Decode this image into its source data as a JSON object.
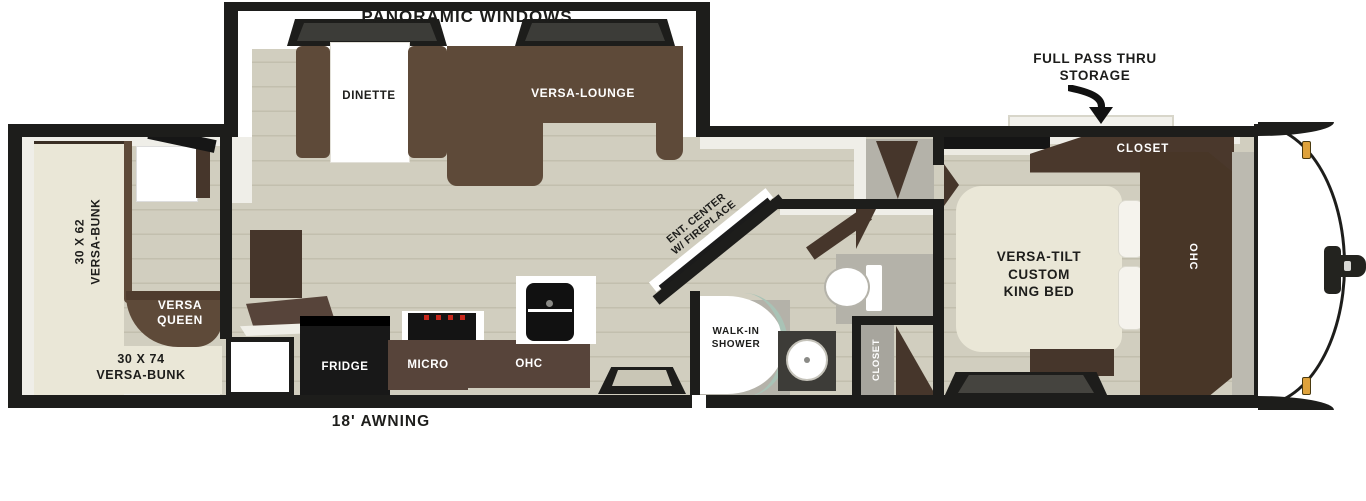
{
  "title": "Travel trailer floor plan",
  "colors": {
    "wall": "#1d1d1b",
    "floor_wood": "#d1cebf",
    "floor_plank_line": "#c2bfae",
    "mattress_cream": "#eae7d7",
    "sofa_brown": "#5e4a39",
    "cabinet_dark_brown": "#46362b",
    "cabinet_mid_brown": "#57443a",
    "bath_gray": "#b4b2a9",
    "shower_glass_teal": "#a9c3b6",
    "marker_light_amber": "#dfa23b",
    "burner_red": "#c8281c"
  },
  "labels": {
    "panoramic_windows": "PANORAMIC WINDOWS",
    "dinette": "DINETTE",
    "versa_lounge": "VERSA-LOUNGE",
    "storage_line1": "FULL PASS THRU",
    "storage_line2": "STORAGE",
    "closet_bedroom": "CLOSET",
    "bed_line1": "VERSA-TILT",
    "bed_line2": "CUSTOM",
    "bed_line3": "KING BED",
    "ohc_bedroom": "OHC",
    "bunk62_line1": "30 X 62",
    "bunk62_line2": "VERSA-BUNK",
    "queen_line1": "VERSA",
    "queen_line2": "QUEEN",
    "bunk74_line1": "30 X 74",
    "bunk74_line2": "VERSA-BUNK",
    "fridge": "FRIDGE",
    "micro": "MICRO",
    "ohc_kitchen": "OHC",
    "ent_line1": "ENT. CENTER",
    "ent_line2": "W/ FIREPLACE",
    "shower_line1": "WALK-IN",
    "shower_line2": "SHOWER",
    "closet_bath": "CLOSET",
    "awning": "18' AWNING"
  },
  "icons": {
    "storage_arrow": "curved-down-arrow-icon",
    "hitch": "trailer-hitch-icon",
    "marker_lights": "amber-marker-light-icon"
  }
}
